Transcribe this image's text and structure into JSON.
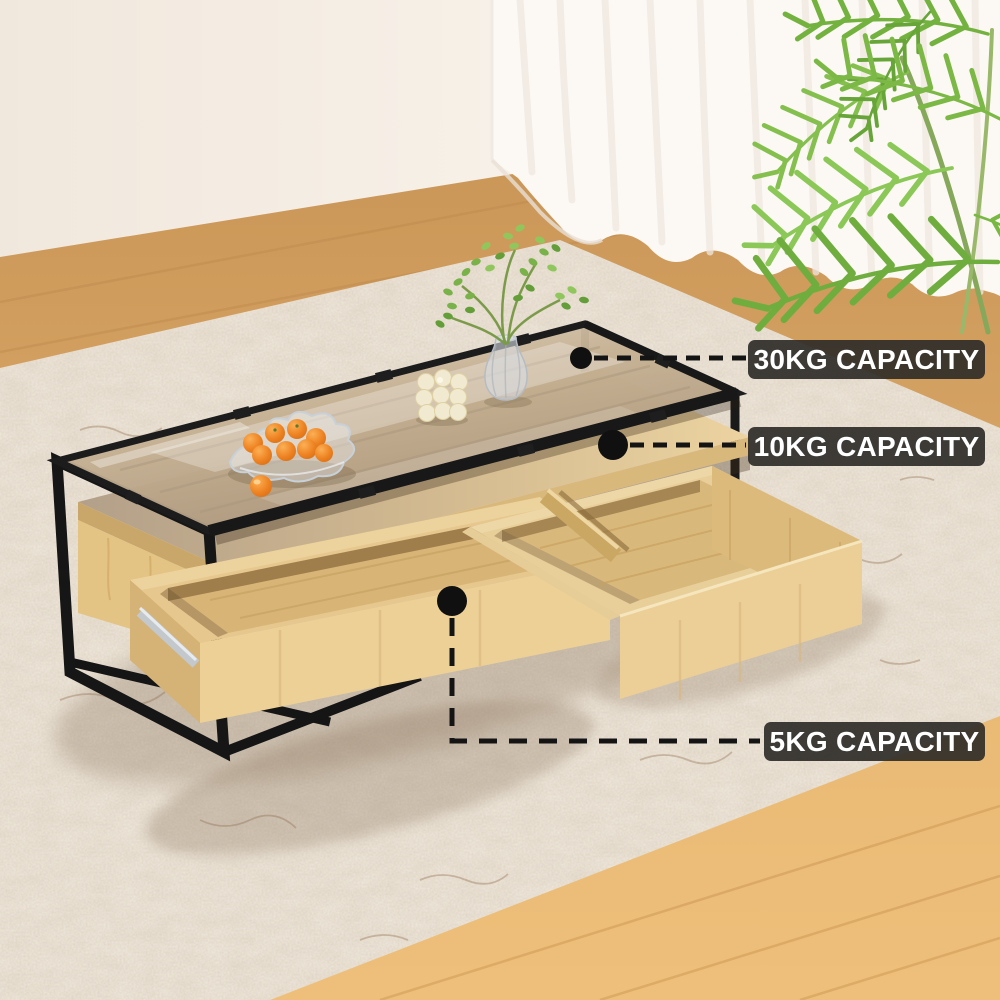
{
  "annotations": {
    "labels": [
      {
        "id": "glass-top-capacity",
        "text": "30KG CAPACITY"
      },
      {
        "id": "shelf-capacity",
        "text": "10KG CAPACITY"
      },
      {
        "id": "drawer-capacity",
        "text": "5KG CAPACITY"
      }
    ],
    "style": {
      "label_bg": "#2f2c29",
      "label_text_color": "#ffffff",
      "leader_color": "#141414",
      "leader_style": "dashed-with-dot"
    }
  },
  "scene": {
    "objects": [
      "wall",
      "sheer-curtain",
      "wood-floor",
      "shag-rug",
      "palm-plant",
      "coffee-table",
      "glass-top",
      "black-metal-frame",
      "wood-shelf",
      "left-drawer-open",
      "right-drawer-open",
      "drawer-slide-rail",
      "fruit-bowl-with-oranges",
      "bubble-candle",
      "glass-vase-with-plant"
    ],
    "palette": {
      "wall": "#f6efe7",
      "curtain": "#fcf9f5",
      "floor": "#d8a668",
      "floor_bright": "#f2c379",
      "rug": "#f2ebdf",
      "wood_light": "#eccf97",
      "wood_mid": "#dcba7c",
      "frame_black": "#161616",
      "leaf_green": "#7cb845",
      "orange_fruit": "#ee8322"
    }
  }
}
